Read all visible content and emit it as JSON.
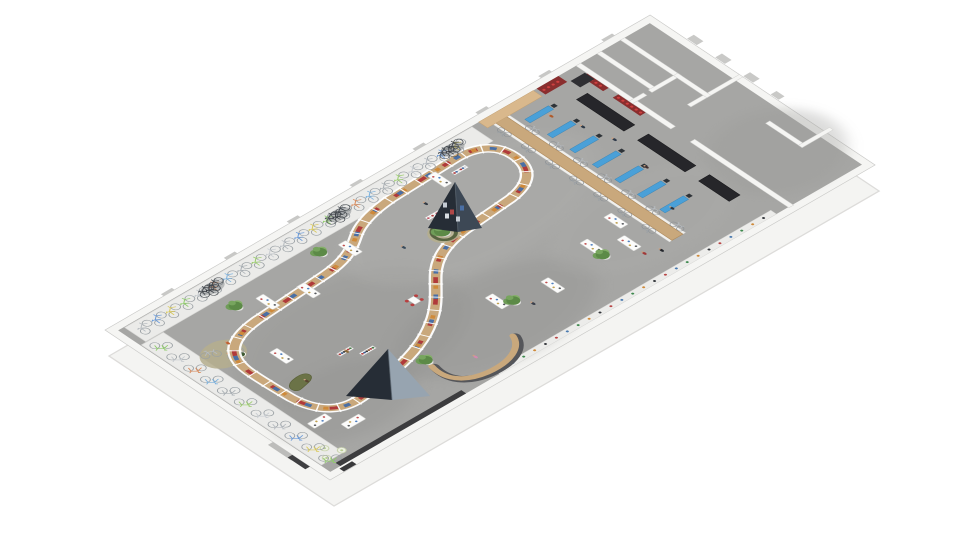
{
  "scene": {
    "description": "3D isometric architectural rendering of a bicycle showroom floor plan with winding display counter, bike racks along walls, workshop area and back rooms",
    "colors": {
      "background": "#ffffff",
      "floor": "#a6a6a4",
      "wall": "#f5f5f3",
      "wall_edge": "#c9c9c7",
      "facade": "#f4f4f2",
      "facade_edge": "#dddcda",
      "platform": "#ebebe9",
      "platform_edge": "#d9d9d7",
      "wood": "#c9a87c",
      "wood_edge": "#b08c5e",
      "rail": "#ffffff",
      "goods_red": "#b03a3a",
      "goods_blue": "#4a6fa5",
      "goods_orange": "#cf8a3a",
      "pyramid_dark": "#262d36",
      "pyramid_mid": "#3d4855",
      "pyramid_light": "#97a4b0",
      "tree_green_1": "#5c8a47",
      "tree_green_2": "#6f9d58",
      "tree_green_3": "#85b06a",
      "pot": "#f2f2f0",
      "pot_edge": "#d8d8d6",
      "ring_ground": "#b5ae8e",
      "hedge": "#4e5c38",
      "sofa": "#6b7347",
      "sofa_edge": "#5a6139",
      "desk_blue": "#4aa0d8",
      "desk_edge": "#3a85b5",
      "bench_dark": "#26262a",
      "red_display": "#8a2e2e",
      "red_dot": "#d04040",
      "wheel": "#9aa0a4",
      "skin": "#caa182",
      "table": "#fcfcfb",
      "table_edge": "#d5d5d3",
      "dark_bike": "#41464c",
      "baseboard": "#3c3c3e",
      "stool_fill": "#edf0e4",
      "stool_edge": "#c9d4ae",
      "stool_dot": "#b9cd92",
      "rug_table": "#3f5a32"
    },
    "building": {
      "length": 1300,
      "width": 560,
      "wall": 16
    },
    "mottle": [
      [
        300,
        300,
        240,
        150,
        "#949492",
        0.35
      ],
      [
        700,
        180,
        280,
        140,
        "#b2b2b0",
        0.3
      ],
      [
        520,
        430,
        220,
        110,
        "#8f8f8d",
        0.3
      ],
      [
        900,
        400,
        200,
        110,
        "#adadab",
        0.28
      ],
      [
        170,
        420,
        150,
        90,
        "#8f8f8d",
        0.3
      ],
      [
        1200,
        420,
        130,
        110,
        "#9b9b99",
        0.35
      ]
    ],
    "platforms": {
      "north": [
        30,
        18,
        828,
        52
      ],
      "west": [
        18,
        72,
        52,
        448
      ]
    },
    "loop_path": "M 104 260 C 102 198 134 164 212 156 L 386 144 C 438 140 466 126 498 104 C 526 84 564 72 616 68 L 772 62 C 830 60 858 86 856 128 C 854 170 826 198 770 206 L 652 216 C 598 222 560 240 528 272 C 498 302 472 336 430 362 C 400 382 356 402 298 414 L 210 430 C 150 440 116 414 108 352 C 106 320 104 292 104 260 Z",
    "cash_desk_path": "M 350 455 C 340 495 360 525 410 532 C 460 538 500 520 512 488",
    "rug": {
      "x": 105,
      "y": 185,
      "rx": 45,
      "ry": 36,
      "bikes": [
        [
          88,
          172,
          25,
          "#b6bbc0"
        ],
        [
          122,
          198,
          -15,
          "#d98a5b"
        ]
      ],
      "table": [
        128,
        206
      ]
    },
    "sofa": {
      "x": 150,
      "y": 330,
      "rot": -18
    },
    "stools": [
      [
        54,
        490
      ],
      [
        38,
        512
      ],
      [
        72,
        514
      ]
    ],
    "tables": [
      [
        262,
        132,
        0
      ],
      [
        336,
        156,
        0
      ],
      [
        176,
        256,
        0
      ],
      [
        470,
        120,
        0
      ],
      [
        716,
        86,
        0
      ],
      [
        100,
        430,
        90
      ],
      [
        142,
        470,
        90
      ],
      [
        556,
        396,
        0
      ],
      [
        658,
        428,
        0
      ],
      [
        782,
        396,
        0
      ],
      [
        836,
        432,
        0
      ],
      [
        862,
        372,
        0
      ]
    ],
    "racks": [
      {
        "x": 266,
        "y": 320,
        "type": "clothes"
      },
      {
        "x": 296,
        "y": 345,
        "type": "clothes"
      },
      {
        "x": 640,
        "y": 150,
        "type": "goods"
      },
      {
        "x": 672,
        "y": 186,
        "type": "goods"
      },
      {
        "x": 760,
        "y": 90,
        "type": "white"
      }
    ],
    "chair_clusters": [
      [
        452,
        298
      ],
      [
        660,
        185
      ]
    ],
    "trees": [
      [
        213,
        106
      ],
      [
        424,
        96
      ],
      [
        352,
        434
      ],
      [
        578,
        416
      ],
      [
        780,
        428
      ]
    ],
    "big_tree": {
      "x": 620,
      "y": 195
    },
    "bikes": {
      "north_row": {
        "count": 23,
        "x0": 58,
        "dx": 34,
        "y": 42,
        "rot": -38,
        "palette": [
          "#b6bbc0",
          "#6a9ad9",
          "#d9c95b",
          "#8fcd6a",
          "#c3c8cd",
          "#d98a5b",
          "#7ab0dd",
          "#aab0b5",
          "#9acd6a",
          "#c9cdd2"
        ]
      },
      "west_col": {
        "count": 11,
        "x": 42,
        "y0": 96,
        "dy": 42,
        "rot": -140
      },
      "dark_clusters": [
        218,
        520,
        790
      ]
    },
    "service": {
      "wood_wall": [
        896,
        36,
        26,
        440
      ],
      "faces": [
        [
          890,
          36,
          6,
          440
        ],
        [
          922,
          36,
          6,
          440
        ]
      ],
      "face_bikes": {
        "count": 7,
        "y0": 66,
        "dy": 60
      },
      "desks_y": [
        64,
        120,
        176,
        232,
        288,
        344,
        400
      ],
      "desk": [
        940,
        56,
        13
      ],
      "benches": [
        [
          1044,
          84,
          26,
          118
        ],
        [
          1044,
          236,
          26,
          118
        ],
        [
          1044,
          388,
          26,
          76
        ]
      ],
      "red_displays": [
        [
          1094,
          44,
          14,
          54
        ],
        [
          1094,
          122,
          14,
          68
        ]
      ],
      "nw_wood_strip": [
        876,
        16,
        130,
        22
      ],
      "nw_red_patch": [
        1014,
        16,
        52,
        22
      ],
      "cabinet": [
        1072,
        40,
        34,
        24
      ]
    },
    "rooms_walls": [
      [
        1108,
        16,
        11,
        236
      ],
      [
        1108,
        300,
        11,
        246
      ],
      [
        1158,
        16,
        10,
        140
      ],
      [
        1108,
        148,
        34,
        9
      ],
      [
        1154,
        148,
        70,
        9
      ],
      [
        1214,
        16,
        10,
        140
      ],
      [
        1176,
        222,
        124,
        9
      ],
      [
        1214,
        148,
        10,
        83
      ],
      [
        1240,
        350,
        10,
        90
      ],
      [
        1240,
        432,
        74,
        9
      ]
    ],
    "accessory_strip": {
      "rect": [
        420,
        530,
        660,
        14
      ],
      "dot_step": 26,
      "dot_colors": [
        "#b84444",
        "#4a7ab0",
        "#3f8a4f",
        "#cf8a3a",
        "#33363b"
      ]
    },
    "baseboard": [
      40,
      532,
      300,
      12
    ],
    "exterior": {
      "ticks": {
        "count": 8,
        "x0": 140,
        "dx": 150,
        "y": -7,
        "w": 26,
        "h": 7
      },
      "tabs": [
        [
          1302,
          90,
          16,
          24
        ],
        [
          1302,
          160,
          16,
          24
        ],
        [
          1302,
          230,
          16,
          24
        ],
        [
          1302,
          298,
          14,
          20
        ]
      ],
      "marks": [
        [
          -12,
          418,
          12,
          58,
          "#bcbcba"
        ],
        [
          -11,
          466,
          11,
          44,
          "#3f3f41"
        ],
        [
          34,
          548,
          30,
          11,
          "#39393b"
        ]
      ]
    },
    "figures": [
      [
        652,
        118,
        "#333a44"
      ],
      [
        268,
        322,
        "#8a6a3a"
      ],
      [
        598,
        442,
        "#3a3f4a"
      ],
      [
        980,
        88,
        "#b05a2a"
      ],
      [
        1016,
        208,
        "#2f3a4a"
      ],
      [
        864,
        484,
        "#23262c"
      ],
      [
        836,
        470,
        "#a03838"
      ],
      [
        422,
        482,
        "#d48ab0"
      ],
      [
        540,
        180,
        "#384a5a"
      ],
      [
        1000,
        146,
        "#2e3a48"
      ],
      [
        1004,
        300,
        "#403030"
      ],
      [
        958,
        412,
        "#2a3440"
      ],
      [
        132,
        168,
        "#c06030"
      ],
      [
        160,
        335,
        "#5a4632"
      ]
    ],
    "pyramids": [
      {
        "apex": [
          455,
          182
        ],
        "base_l": [
          428,
          228
        ],
        "base_r": [
          482,
          228
        ],
        "mid": [
          458,
          232
        ],
        "cards": [
          [
            445,
            205
          ],
          [
            452,
            212
          ],
          [
            462,
            208
          ],
          [
            447,
            216
          ],
          [
            458,
            219
          ]
        ]
      },
      {
        "apex": [
          388,
          349
        ],
        "base_l": [
          346,
          396
        ],
        "base_r": [
          430,
          396
        ],
        "mid": [
          392,
          400
        ],
        "cards": []
      }
    ]
  }
}
